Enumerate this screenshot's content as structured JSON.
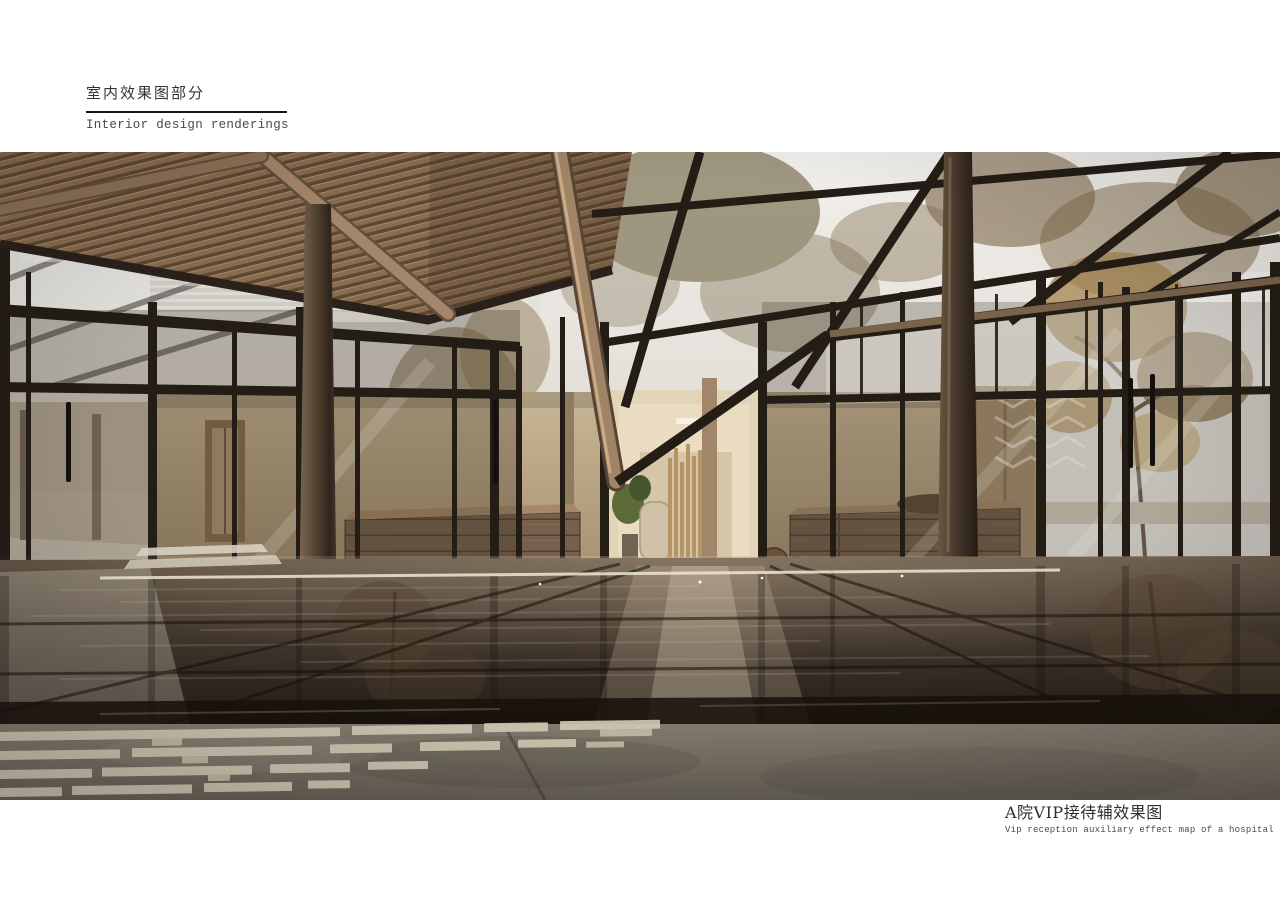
{
  "header": {
    "title_cn": "室内效果图部分",
    "title_en": "Interior design renderings"
  },
  "caption": {
    "title_cn": "A院VIP接待辅效果图",
    "subtitle_en": "Vip reception auxiliary effect map of a hospital"
  },
  "figure": {
    "kind": "interior-architectural-rendering",
    "palette": {
      "page_background": "#ffffff",
      "text_dark": "#343434",
      "text_grey": "#4a4a4a",
      "rule_black": "#141414",
      "wood_slat": "#8a6c50",
      "wood_log": "#a4866a",
      "steel_frame": "#241d16",
      "plaster_wall": "#c1ae8e",
      "corridor_light": "#e6d8bc",
      "sky_glass": "#f0eeea",
      "autumn_foliage": "#a2824c",
      "floor_dark": "#332a22",
      "paving_stripe": "#d2cbb6",
      "concrete": "#756e62"
    }
  }
}
